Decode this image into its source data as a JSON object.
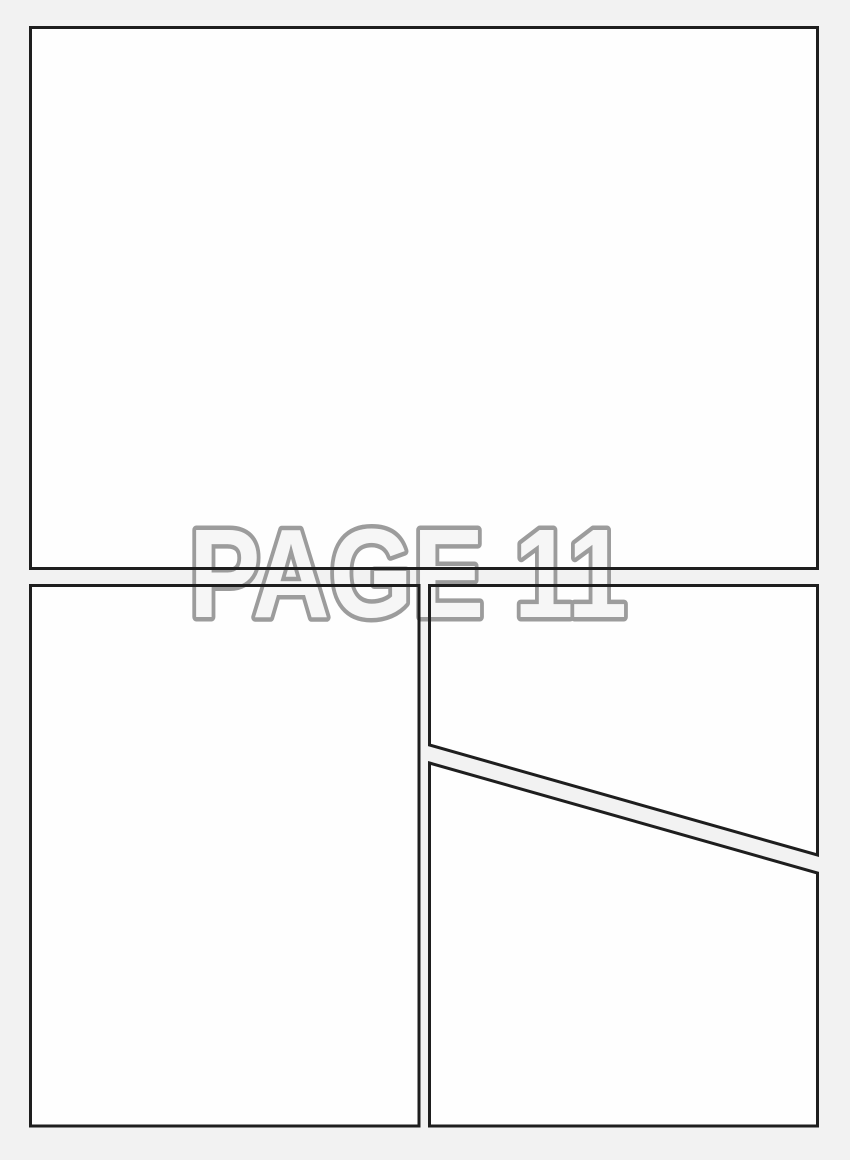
{
  "watermark": {
    "text": "PAGE 11"
  },
  "colors": {
    "page_background": "#f2f2f2",
    "panel_fill": "#fefefe",
    "border": "#1e1e1e",
    "watermark_fill": "#f6f6f6",
    "watermark_stroke": "#9c9c9c"
  },
  "panels": [
    {
      "id": "top",
      "shape": "rectangle"
    },
    {
      "id": "bottom-left",
      "shape": "rectangle"
    },
    {
      "id": "top-right",
      "shape": "polygon-diagonal-bottom"
    },
    {
      "id": "bottom-right",
      "shape": "polygon-diagonal-top"
    }
  ]
}
